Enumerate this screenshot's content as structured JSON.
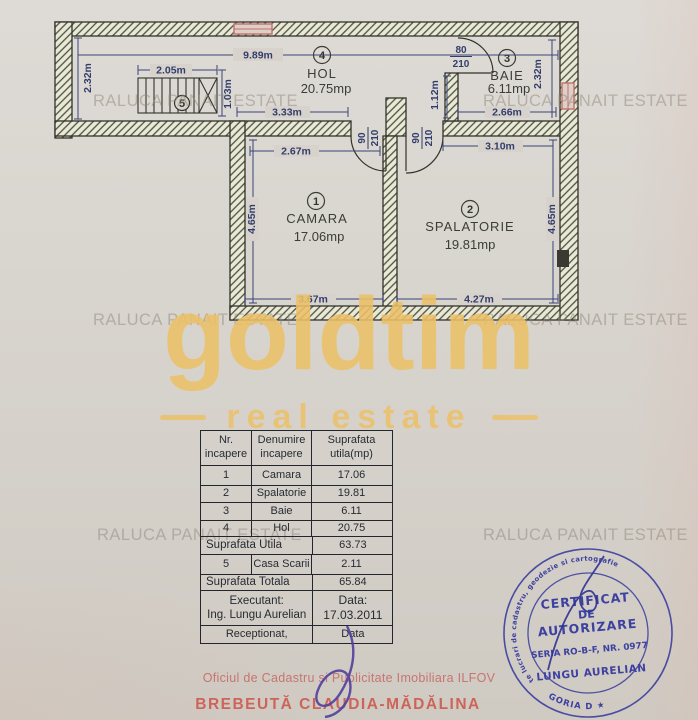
{
  "plan": {
    "rooms": [
      {
        "num": "1",
        "name": "CAMARA",
        "area": "17.06mp"
      },
      {
        "num": "2",
        "name": "SPALATORIE",
        "area": "19.81mp"
      },
      {
        "num": "3",
        "name": "BAIE",
        "area": "6.11mp"
      },
      {
        "num": "4",
        "name": "HOL",
        "area": "20.75mp"
      },
      {
        "num": "5",
        "name": "",
        "area": ""
      }
    ],
    "dims": {
      "top": "9.89m",
      "left": "2.32m",
      "stairs_w": "2.05m",
      "stairs_h": "1.03m",
      "hol": "3.33m",
      "camara_top": "2.67m",
      "camara_side": "4.65m",
      "camara_bottom": "3.67m",
      "spalatorie_top": "3.10m",
      "spalatorie_side": "4.65m",
      "spalatorie_bottom": "4.27m",
      "baie_bottom": "2.66m",
      "baie_left": "1.12m",
      "baie_side": "2.32m"
    },
    "doors": {
      "interior_w": "90",
      "interior_h": "210",
      "baie_w": "80",
      "baie_h": "210"
    }
  },
  "watermark": {
    "text": "RALUCA PANAIT ESTATE"
  },
  "brand": {
    "name": "goldtim",
    "tagline": "real estate"
  },
  "table": {
    "headers": [
      [
        "Nr.",
        "incapere"
      ],
      [
        "Denumire",
        "incapere"
      ],
      [
        "Suprafata",
        "utila(mp)"
      ]
    ],
    "rows": [
      [
        "1",
        "Camara",
        "17.06"
      ],
      [
        "2",
        "Spalatorie",
        "19.81"
      ],
      [
        "3",
        "Baie",
        "6.11"
      ],
      [
        "4",
        "Hol",
        "20.75"
      ]
    ],
    "utila_label": "Suprafata Utila",
    "utila_value": "63.73",
    "row5": [
      "5",
      "Casa Scarii",
      "2.11"
    ],
    "totala_label": "Suprafata Totala",
    "totala_value": "65.84",
    "executant_label": "Executant:",
    "executant_name": "Ing. Lungu Aurelian",
    "data_label": "Data:",
    "data_value": "17.03.2011",
    "receptionat_label": "Receptionat,",
    "data_word": "Data"
  },
  "stamp": {
    "ring_text": "Persoana fizica autorizata de ANCPI sa execute lucrari de cadastru, geodezie si cartografie",
    "bottom_text": "★ CATEGORIA D ★",
    "line1": "CERTIFICAT",
    "line2": "DE",
    "line3": "AUTORIZARE",
    "line4": "SERIA RO-B-F, NR. 0977",
    "line5": "LUNGU AURELIAN"
  },
  "footer": {
    "office": "Oficiul de Cadastru si Publicitate Imobiliara ILFOV",
    "name": "BREBEUTĂ CLAUDIA-MĂDĂLINA"
  }
}
